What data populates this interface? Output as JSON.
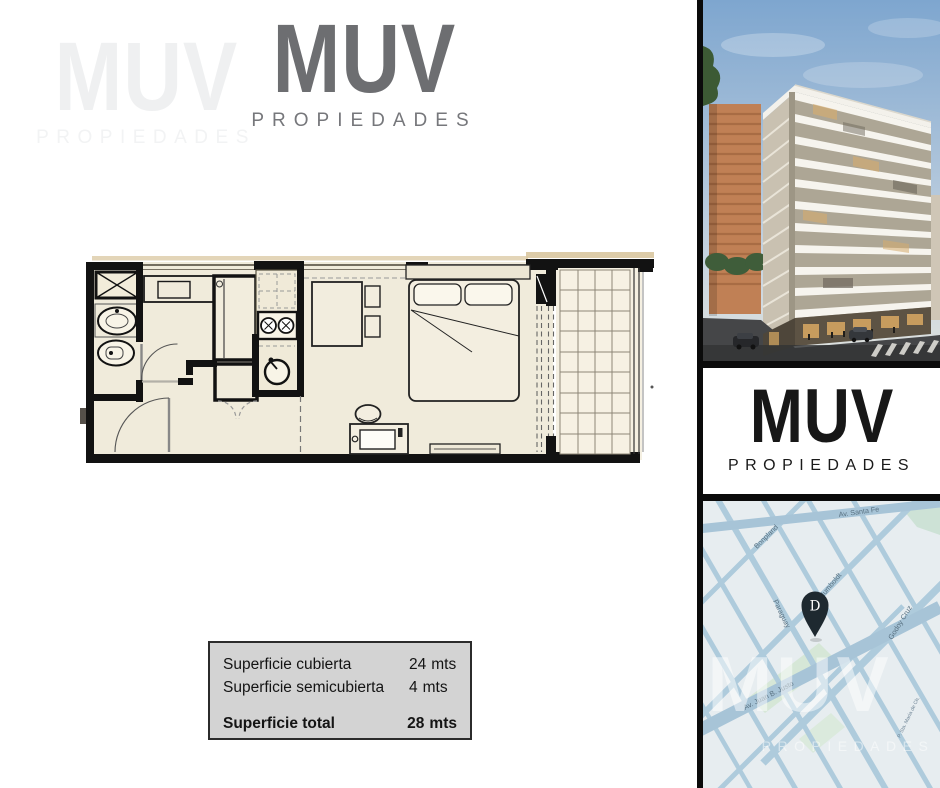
{
  "brand": {
    "title": "MUV",
    "tagline": "PROPIEDADES"
  },
  "watermark": {
    "title": "MUV",
    "tagline": "PROPIEDADES"
  },
  "surface_box": {
    "rows": [
      {
        "label": "Superficie cubierta",
        "value": "24",
        "unit": "mts"
      },
      {
        "label": "Superficie semicubierta",
        "value": "4",
        "unit": "mts"
      }
    ],
    "total": {
      "label": "Superficie total",
      "value": "28",
      "unit": "mts"
    }
  },
  "map": {
    "streets": [
      "Av. Santa Fe",
      "Bonpland",
      "Paraguay",
      "Humboldt",
      "Godoy Cruz",
      "Av. Juan B. Justo",
      "P. Sta. María de Ch."
    ],
    "pin_letter": "D",
    "watermark_title": "MUV",
    "watermark_tagline": "PROPIEDADES"
  },
  "colors": {
    "accent_black": "#0b0b0b",
    "logo_gray": "#6d6e71",
    "plan_floor": "#f0ebdb",
    "info_box_bg": "#d3d3d3",
    "map_street": "#aecbdc",
    "pin": "#1e2930"
  }
}
